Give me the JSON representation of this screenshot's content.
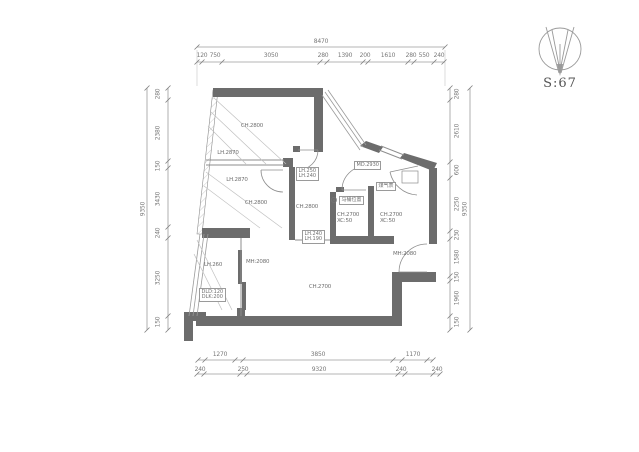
{
  "compass": {
    "scale_label": "S:67"
  },
  "dims": {
    "top": {
      "overall": "8470",
      "segments": [
        "120",
        "750",
        "3050",
        "280",
        "1390",
        "200",
        "1610",
        "280",
        "550",
        "240"
      ]
    },
    "left": {
      "overall": "9350",
      "segments": [
        "280",
        "2380",
        "150",
        "3430",
        "240",
        "3250",
        "150"
      ]
    },
    "right": {
      "overall": "9350",
      "segments": [
        "280",
        "2610",
        "600",
        "2250",
        "230",
        "1580",
        "150",
        "1960",
        "150"
      ]
    },
    "bottom": {
      "overall": "9320",
      "inner": [
        "1270",
        "3850",
        "1170"
      ],
      "outer": [
        "240",
        "250",
        "240",
        "240"
      ]
    }
  },
  "plan": {
    "bedroom1": {
      "ch": "CH.2800",
      "lh1": "LH.2870",
      "lh2": "LH.2870"
    },
    "bedroom2": {
      "ch": "CH.2800"
    },
    "hall": {
      "ch": "CH.2800",
      "sill_box": {
        "l1": "LH.250",
        "l2": "LH.240"
      },
      "threshold_box": {
        "l1": "LH.240",
        "l2": "LH.190"
      }
    },
    "bathroom": {
      "ch": "CH.2700",
      "xc": "XC:50",
      "toilet_label": "马桶位置"
    },
    "kitchen": {
      "ch": "CH.2700",
      "xc": "XC:50",
      "door_label": "MD.2930",
      "gas_meter_label": "煤气表",
      "exit_door_label": "MH:2080"
    },
    "living": {
      "ch": "CH.2700",
      "sliding_door_label": "MH:2080"
    },
    "balcony": {
      "sill_label": "LH.260",
      "note1": "DLD:120",
      "note2": "DLK:200"
    }
  }
}
